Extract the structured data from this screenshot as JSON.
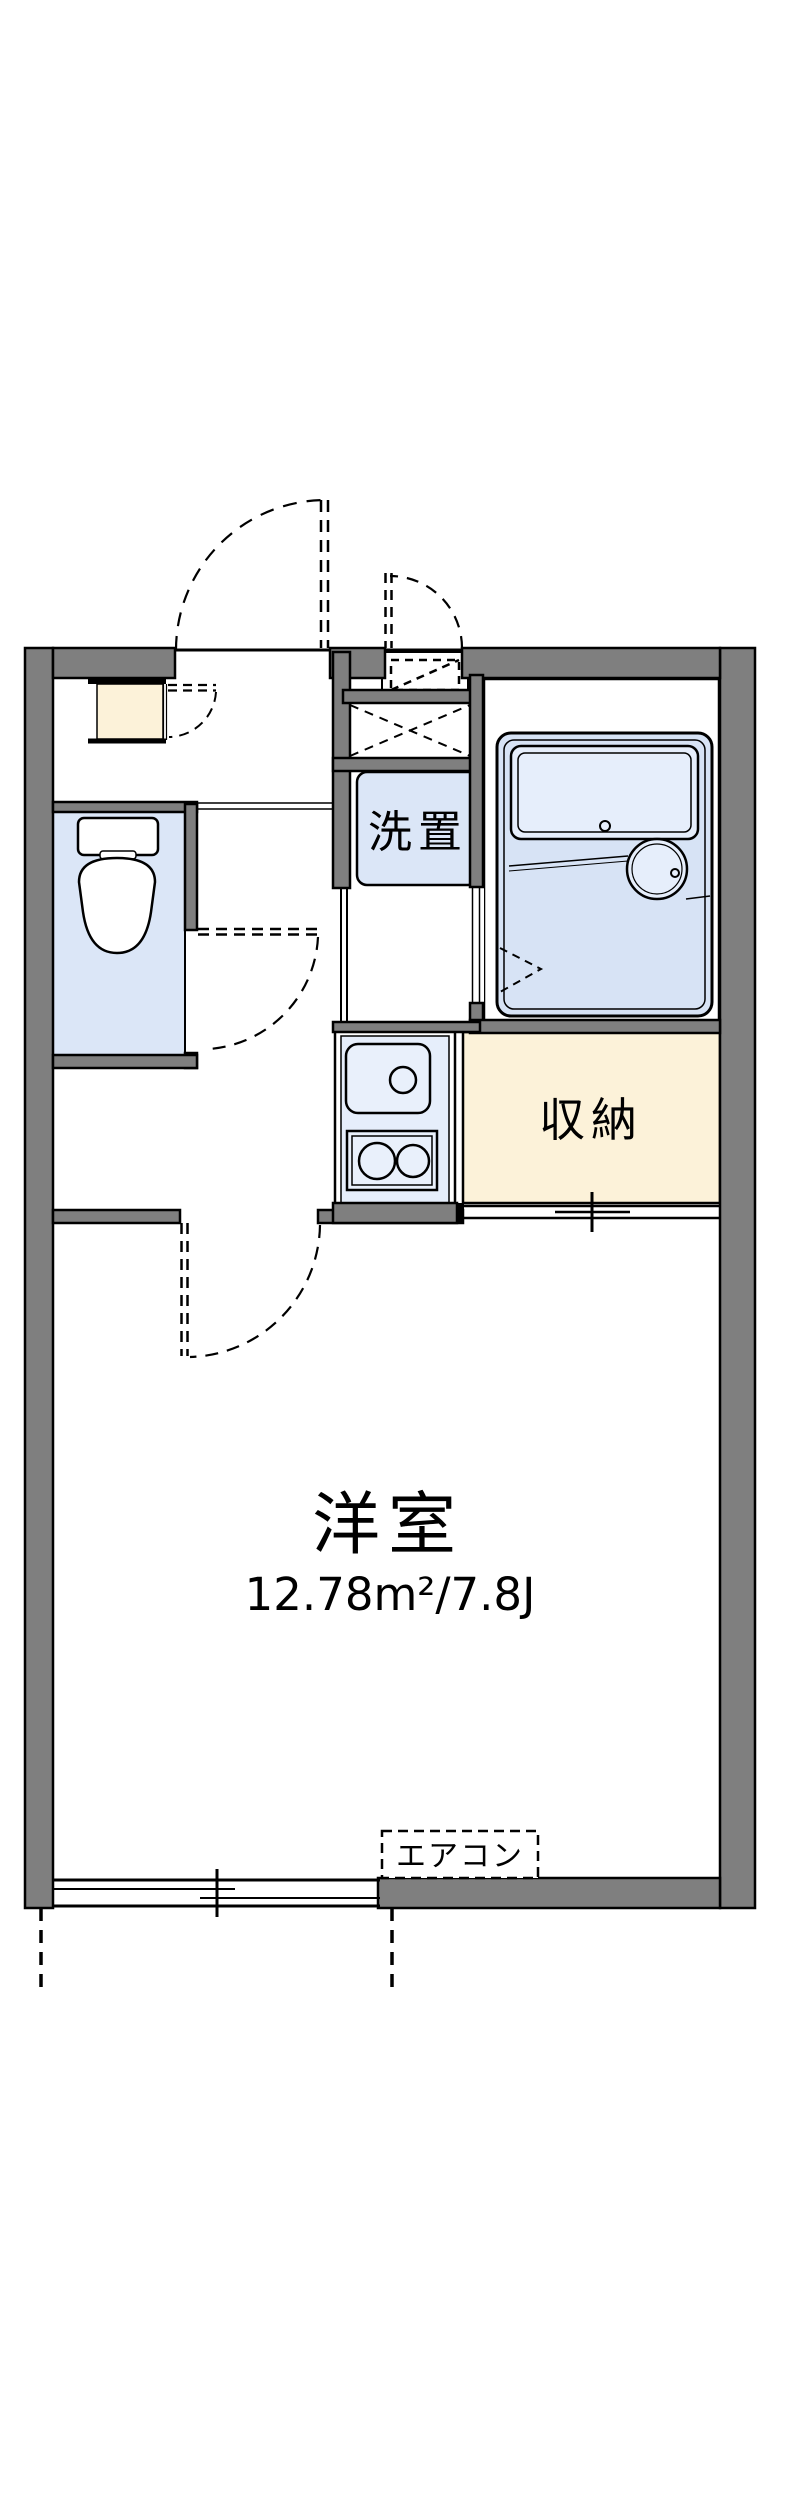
{
  "labels": {
    "washer": "洗置",
    "storage": "収納",
    "main_room": "洋室",
    "main_room_area": "12.78m²/7.8J",
    "aircon": "エアコン"
  },
  "colors": {
    "wall_gray": "#7f7f7f",
    "line_black": "#000000",
    "floor_blue": "#dbe6f7",
    "fixture_blue": "#e6eefb",
    "cream": "#fcf2d9",
    "white": "#ffffff"
  }
}
